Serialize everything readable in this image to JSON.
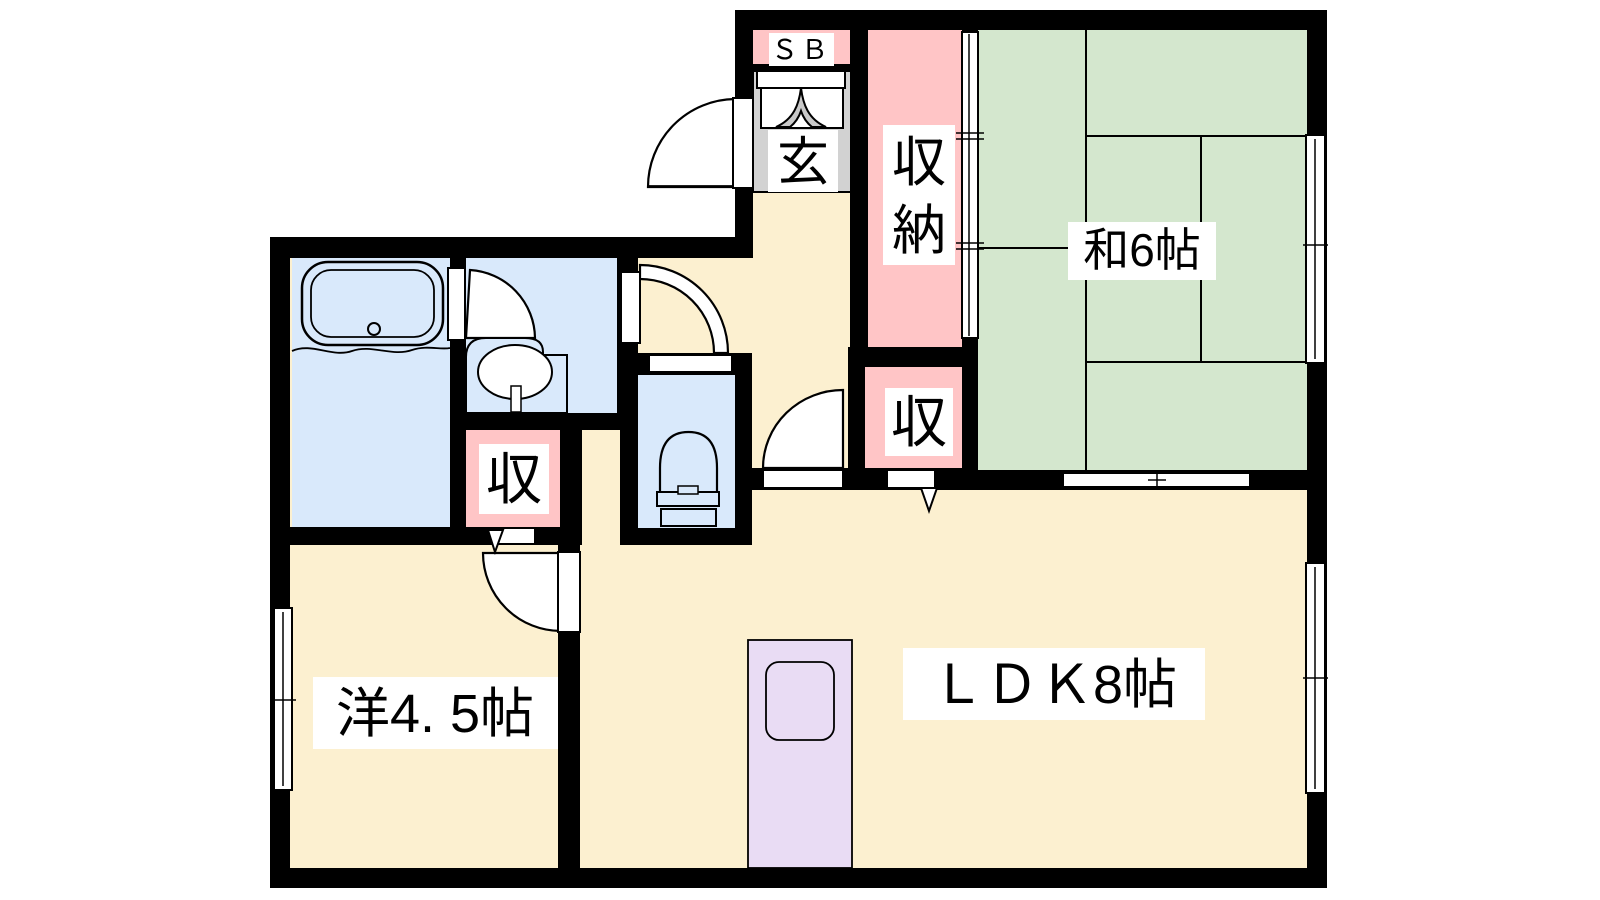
{
  "plan": {
    "title": "1LDK-floor-plan",
    "labels": {
      "japanese_room": "和6帖",
      "ldk": "ＬＤＫ8帖",
      "western_room": "洋4. 5帖",
      "closet_vertical": [
        "収",
        "納"
      ],
      "closet_west": "収",
      "closet_east": "収",
      "entrance": "玄",
      "shoe_box": "ＳＢ"
    },
    "colors": {
      "wall": "#000000",
      "floor_cream": "#fcf0d0",
      "tatami_green": "#d4e7ce",
      "closet_pink": "#ffc5c6",
      "wet_area_blue": "#d9e9fb",
      "entrance_gray": "#d2d2d2",
      "kitchen_purple": "#e9dcf4",
      "label_bg": "#ffffff",
      "door_white": "#ffffff",
      "arrow_gray": "#c9c9c9"
    }
  }
}
